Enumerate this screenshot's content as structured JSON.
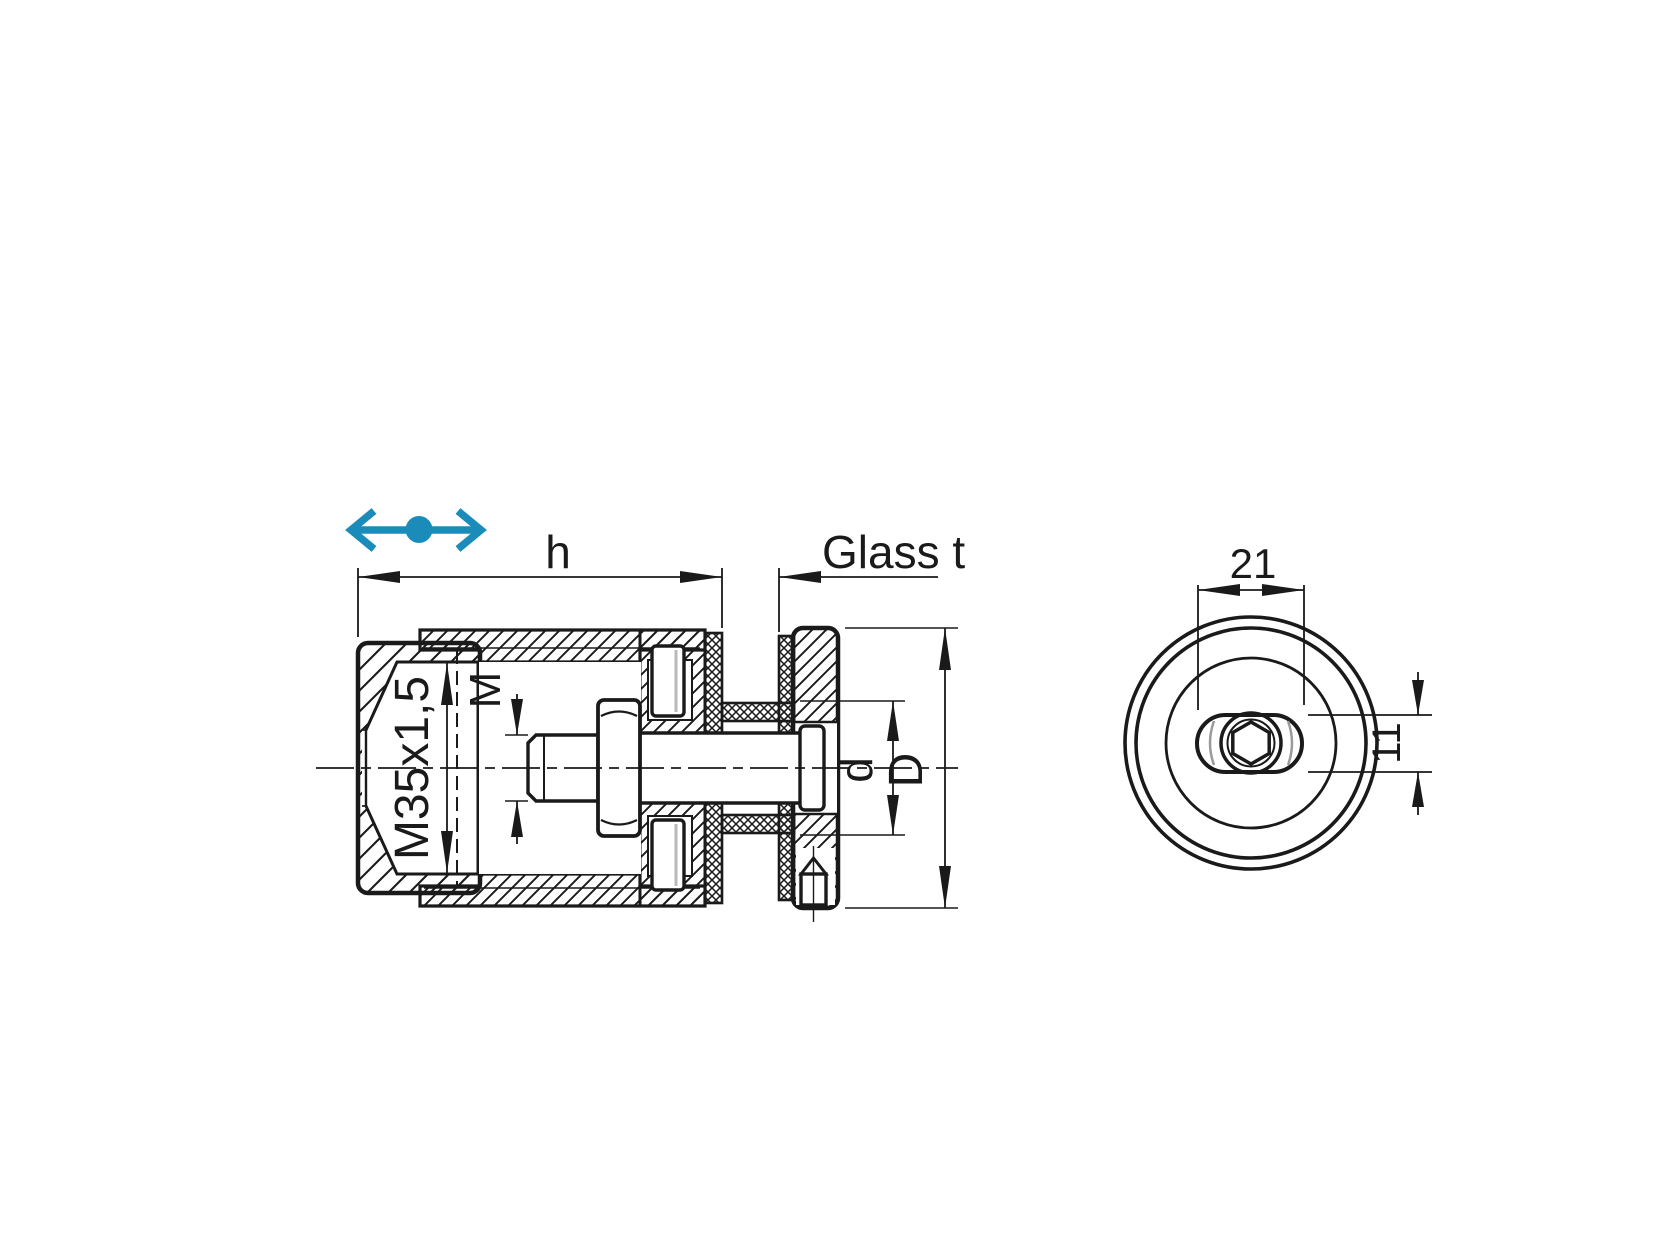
{
  "drawing": {
    "type": "technical-section-drawing",
    "colors": {
      "line": "#1a1a1a",
      "accent": "#1b8cba",
      "background": "#ffffff",
      "detail_gray": "#9a9a9a"
    },
    "icons": {
      "move_horizontal": "double-headed-horizontal-arrow-with-center-dot"
    },
    "views": {
      "section": {
        "dimensions": {
          "h": "h",
          "glass_t": "Glass t",
          "body_thread": "M35x1,5",
          "bolt_thread": "M",
          "stud_dia": "d",
          "outer_dia": "D"
        }
      },
      "front": {
        "dimensions": {
          "slot_width": "21",
          "slot_height": "11"
        }
      }
    }
  }
}
